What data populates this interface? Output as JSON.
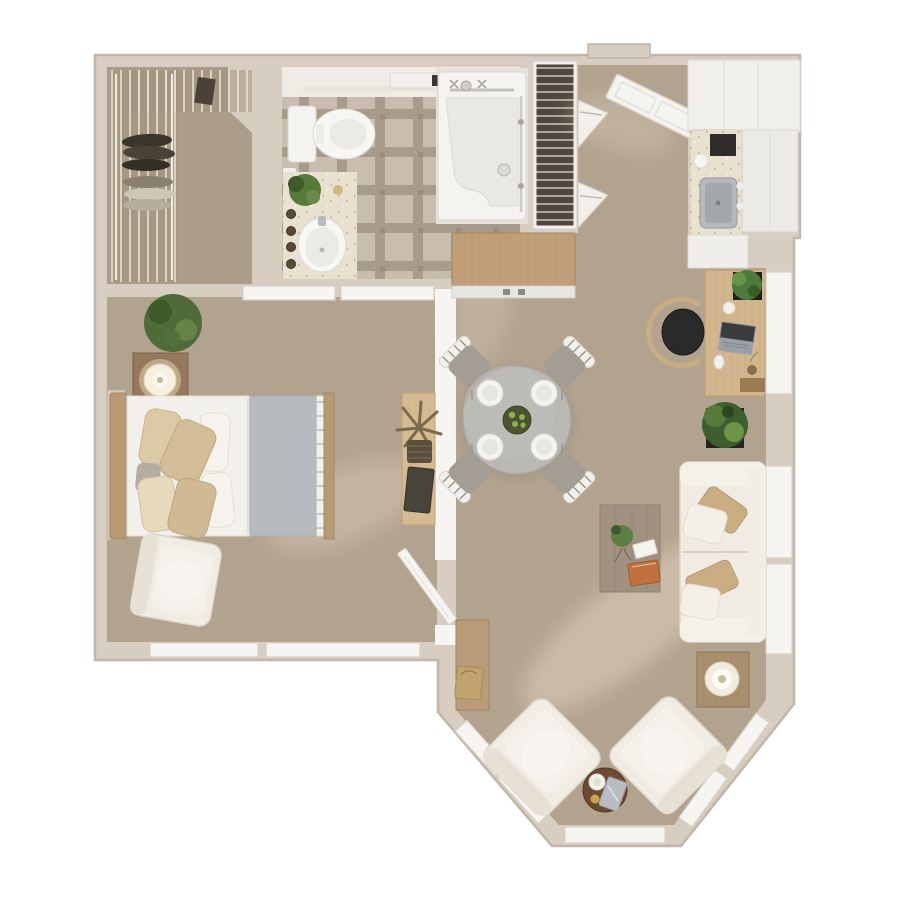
{
  "plan": {
    "type": "apartment-floor-plan-3d-top-view",
    "rooms": {
      "closet": "walk-in-closet",
      "bathroom": "bathroom",
      "shower": "walk-in-shower",
      "linen": "linen-closet",
      "entry": "entry-hall",
      "kitchen": "kitchenette",
      "bedroom": "bedroom",
      "living": "living-dining-area",
      "bay": "bay-window-nook"
    },
    "furniture": [
      "wire-shelving",
      "hanging-clothes",
      "toilet",
      "grab-bar",
      "vanity-sink",
      "shower-stall",
      "entry-door",
      "wall-baskets",
      "upper-cabinets",
      "refrigerator",
      "kitchen-counter-sink",
      "coffee-maker",
      "hall-dresser",
      "desk",
      "laptop",
      "office-chair",
      "floor-plant",
      "dining-table",
      "dining-chairs",
      "plates",
      "console-table",
      "palm-plant",
      "bed",
      "pillows",
      "gray-throw",
      "nightstand",
      "table-lamp",
      "bedroom-plant",
      "wall-unit",
      "bedroom-armchair",
      "bedroom-door",
      "sofa",
      "sofa-pillows",
      "coffee-table",
      "orange-book",
      "side-console",
      "bag",
      "bay-armchair-left",
      "bay-armchair-right",
      "round-side-table",
      "lamp-side-table",
      "windows"
    ]
  },
  "palette": {
    "background": "#ffffff",
    "wall": "#d7cdc0",
    "wall_edge": "#c1b6a7",
    "wall_white": "#f7f5f1",
    "carpet": "#b2a38f",
    "carpet_closet": "#ab9d89",
    "carpet_light": "#e9dcc6",
    "tile_dark": "#a79c8c",
    "tile_light": "#c8bdae",
    "fixture_white": "#f4f3f0",
    "fixture_stroke": "#d9d6d0",
    "window_white": "#f6f5f2",
    "wood_light": "#d2b68d",
    "wood_mid": "#b79a74",
    "wood_gray": "#a09180",
    "wood_dark": "#6d4a33",
    "sofa_cream": "#f0ece4",
    "cushion_light": "#f4f1ea",
    "pillow_tan": "#d2bd97",
    "throw_gray": "#b6b9be",
    "dining_table_gray": "#bab8b4",
    "dining_chair_gray": "#a39d94",
    "office_chair_black": "#2a2a2a",
    "plant_green": "#557a3a",
    "plant_green_dark": "#3e5a2c",
    "planter_black": "#23231f",
    "linen_dark": "#4f473d",
    "counter_speckle": "#e9e1d0",
    "steel": "#b6babc",
    "accent_orange": "#c1703f",
    "bag_tan": "#c2a36e",
    "gold": "#c9a448"
  }
}
